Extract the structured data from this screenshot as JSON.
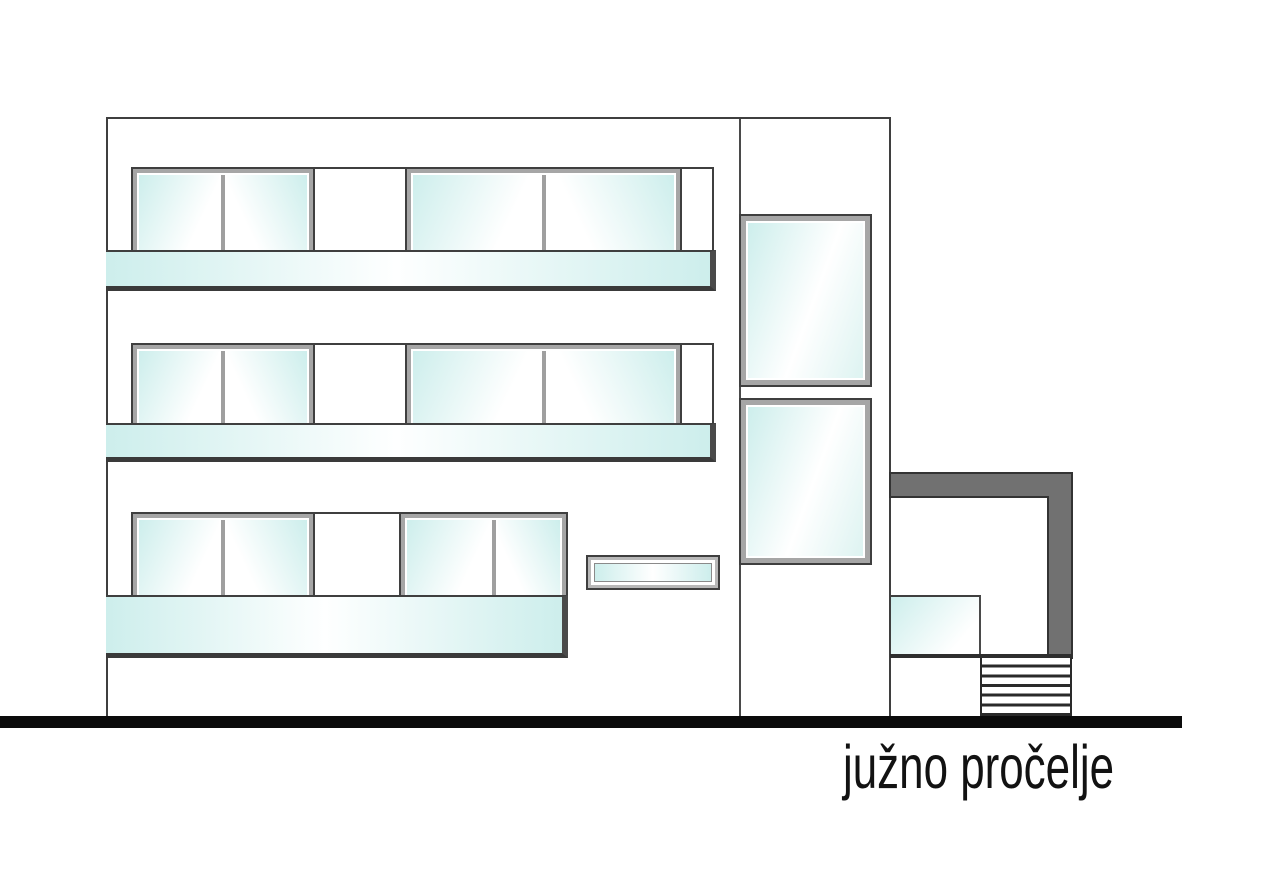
{
  "caption": {
    "label": "južno pročelje"
  },
  "colors": {
    "glass_cyan": "#cdeeec",
    "frame_gray": "#a6a6a6",
    "outline_dark": "#3f3f3f",
    "canopy_gray": "#717171",
    "ground_black": "#0b0b0b",
    "text_black": "#121212"
  }
}
